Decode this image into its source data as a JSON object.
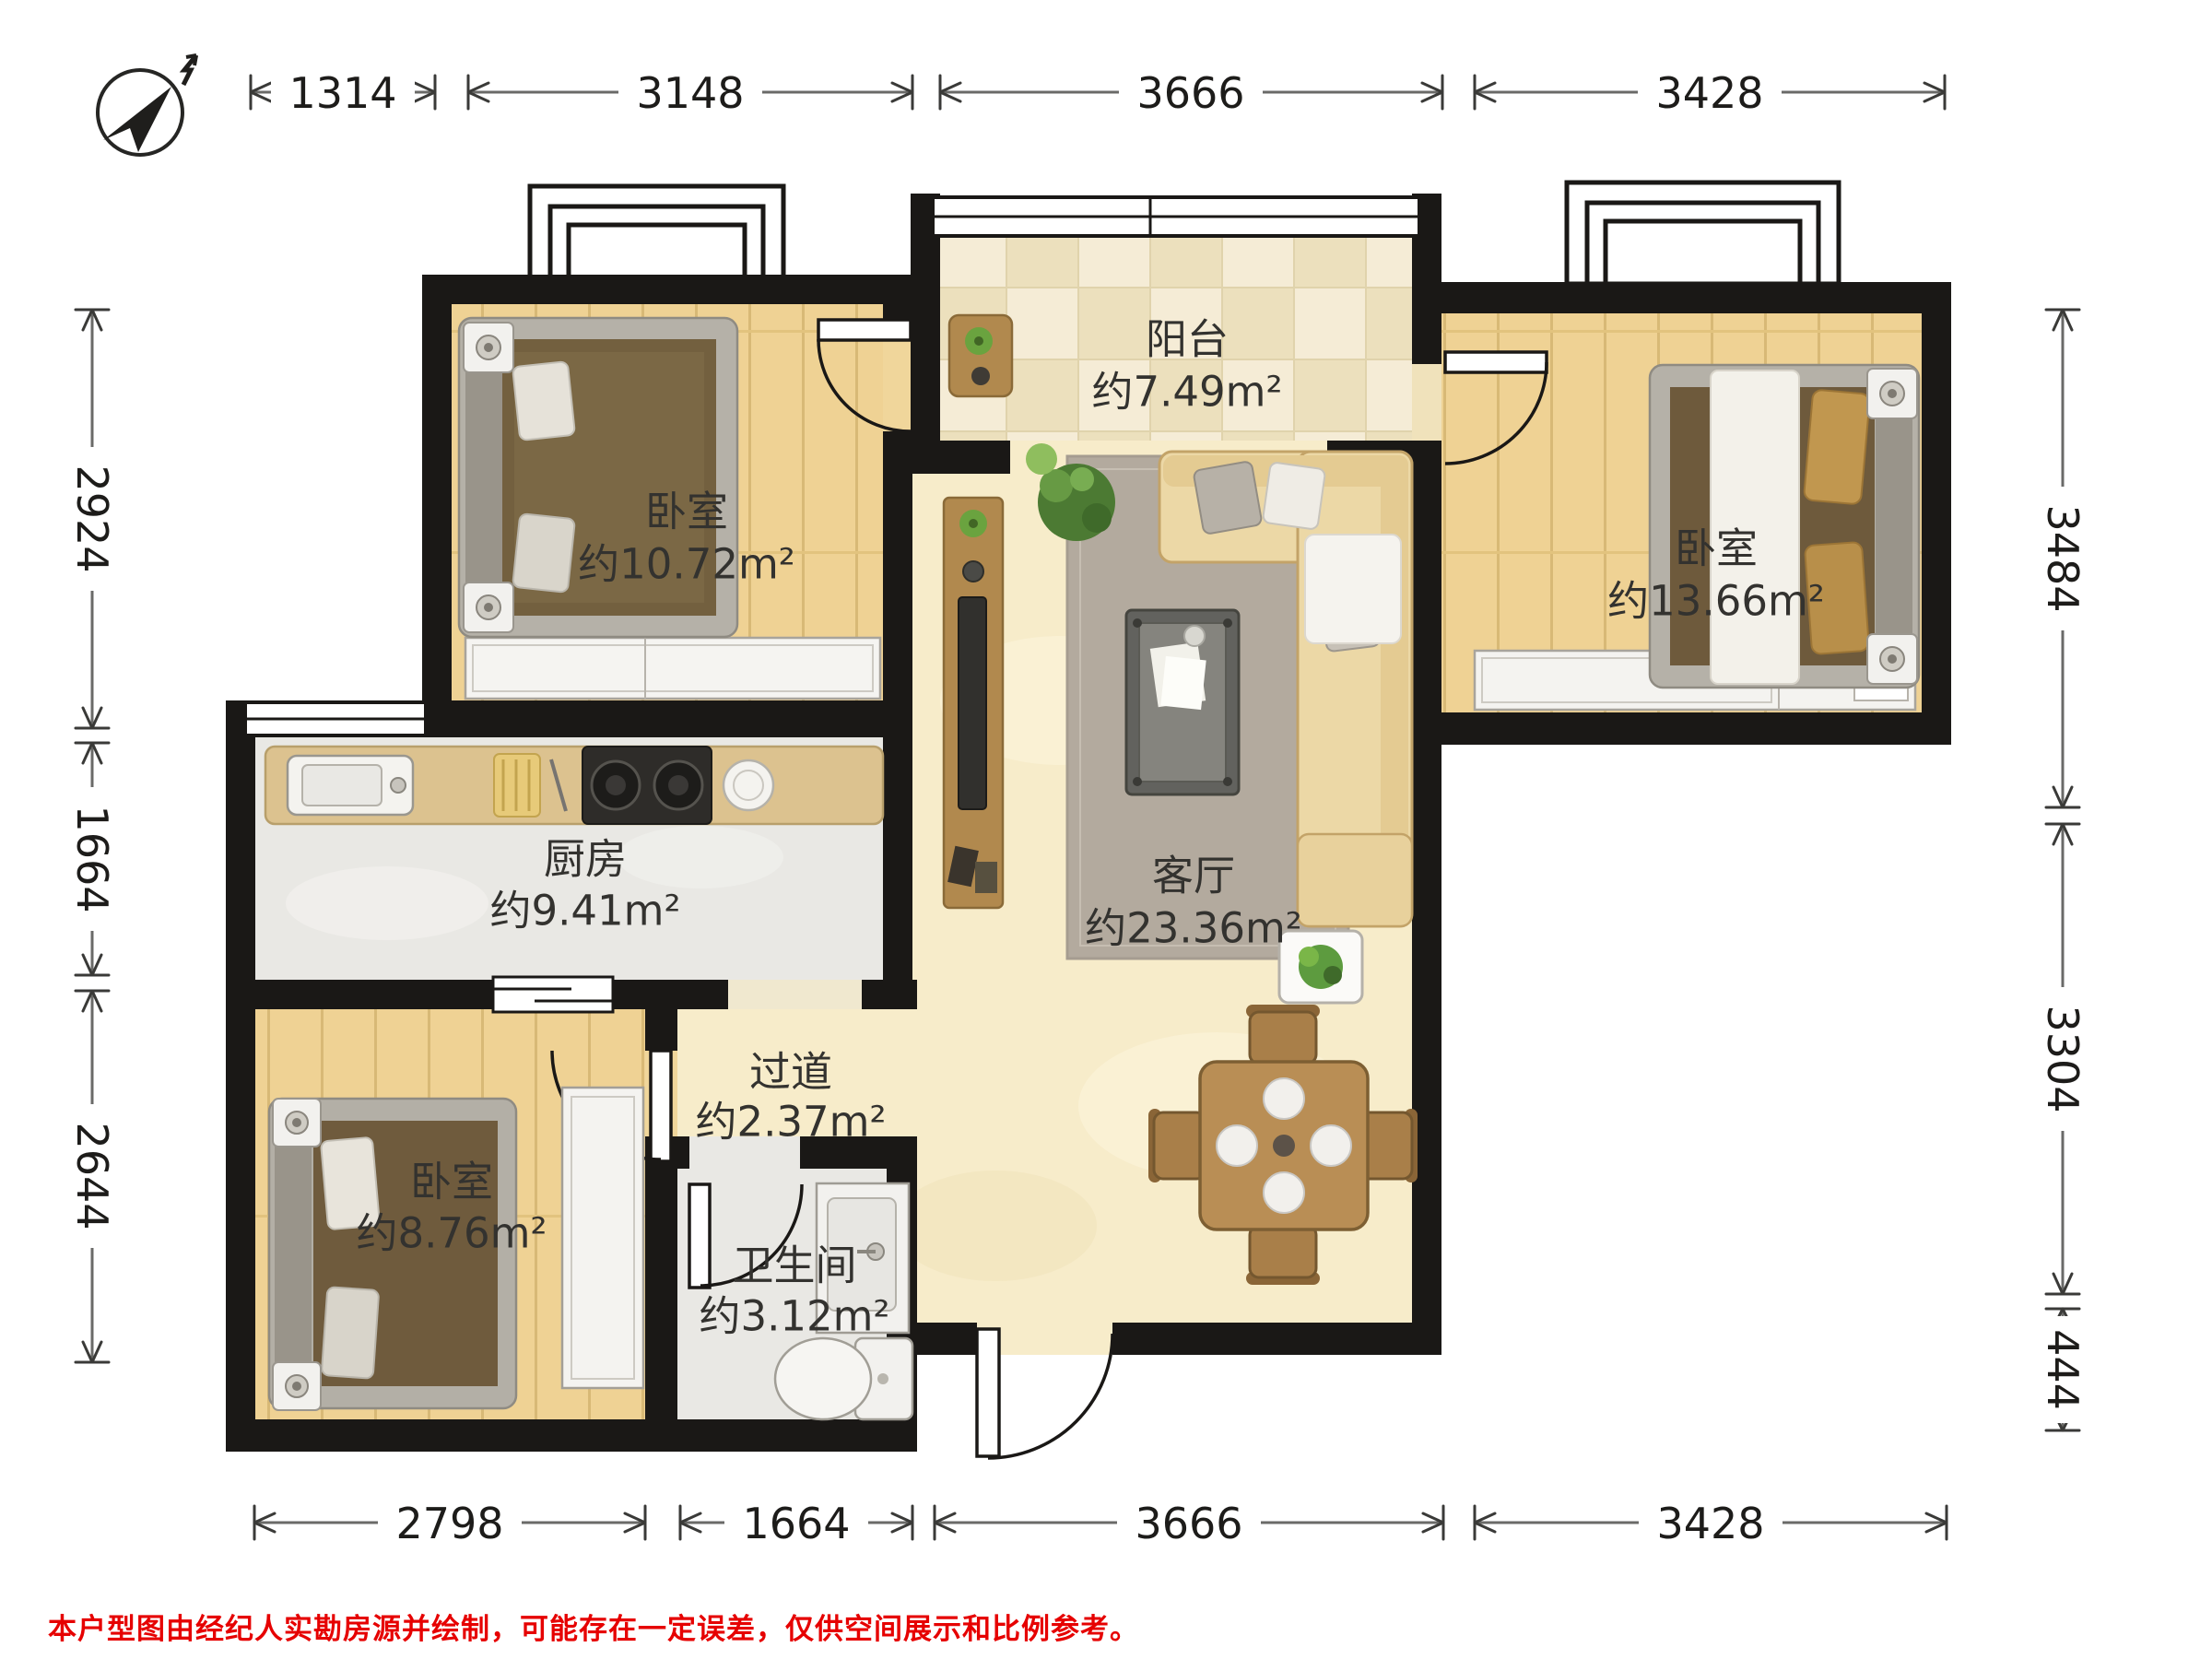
{
  "dimensions": {
    "top": [
      "1314",
      "3148",
      "3666",
      "3428"
    ],
    "bottom": [
      "2798",
      "1664",
      "3666",
      "3428"
    ],
    "left": [
      "2924",
      "1664",
      "2644"
    ],
    "right": [
      "3484",
      "3304",
      "444"
    ]
  },
  "rooms": {
    "balcony": {
      "name": "阳台",
      "area": "约7.49m²"
    },
    "bedroom_top_left": {
      "name": "卧室",
      "area": "约10.72m²"
    },
    "bedroom_top_right": {
      "name": "卧室",
      "area": "约13.66m²"
    },
    "kitchen": {
      "name": "厨房",
      "area": "约9.41m²"
    },
    "living_room": {
      "name": "客厅",
      "area": "约23.36m²"
    },
    "hallway": {
      "name": "过道",
      "area": "约2.37m²"
    },
    "bedroom_bottom_left": {
      "name": "卧室",
      "area": "约8.76m²"
    },
    "bathroom": {
      "name": "卫生间",
      "area": "约3.12m²"
    }
  },
  "footer": {
    "disclaimer": "本户型图由经纪人实勘房源并绘制，可能存在一定误差，仅供空间展示和比例参考。"
  },
  "colors": {
    "wall": "#1a1816",
    "wood_floor": "#efd294",
    "marble_floor": "#f7ecca",
    "balcony_tile_light": "#f5ecd6",
    "balcony_tile_dark": "#ece0bd",
    "stone_floor": "#e9e8e4",
    "counter": "#dcc28f",
    "disclaimer_red": "#e60000"
  }
}
